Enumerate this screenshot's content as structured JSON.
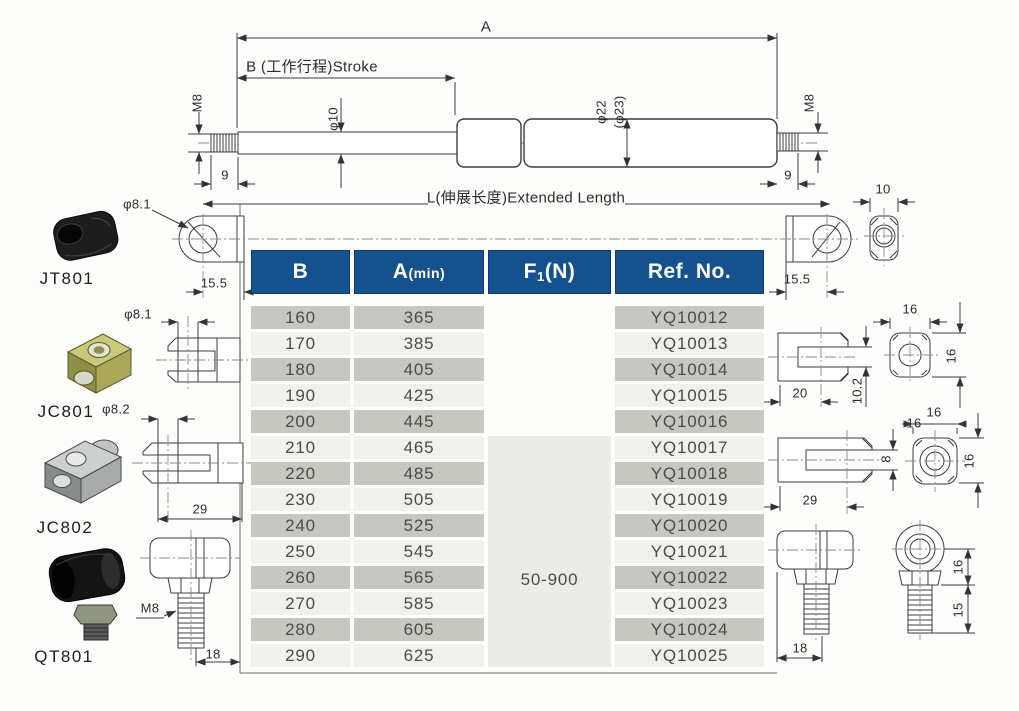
{
  "drawing": {
    "dim_a": "A",
    "dim_b_stroke": "B (工作行程)Stroke",
    "dim_phi10": "φ10",
    "dim_phi22": "φ22",
    "dim_phi23": "(φ23)",
    "dim_m8_left": "M8",
    "dim_m8_right": "M8",
    "dim_9_left": "9",
    "dim_9_right": "9",
    "extended_length": "L(伸展长度)Extended Length",
    "dim_155_left": "15.5",
    "dim_155_right": "15.5"
  },
  "fittings": {
    "jt801": {
      "name": "JT801",
      "hole_dia": "φ8.1"
    },
    "jc801": {
      "name": "JC801",
      "hole_dia": "φ8.1"
    },
    "jc802": {
      "name": "JC802",
      "hole_dia": "φ8.2",
      "width": "29"
    },
    "qt801": {
      "name": "QT801",
      "thread": "M8",
      "width": "18"
    }
  },
  "right_views": {
    "eyelet_side": {
      "width": "10"
    },
    "clevis_small": {
      "width_top": "16",
      "height": "16",
      "depth": "20",
      "slot": "10.2"
    },
    "clevis_big": {
      "width_top_a": "16",
      "width_top_b": "16",
      "height": "16",
      "slot": "8",
      "depth": "29"
    },
    "ball_joint": {
      "eye_height": "16",
      "stud_len": "15",
      "width": "18"
    }
  },
  "table": {
    "headers": {
      "b": "B",
      "a": "A",
      "a_sub": "(min)",
      "f": "F",
      "f_sub": "1",
      "f_tail": "(N)",
      "ref": "Ref. No."
    },
    "f1_value": "50-900",
    "rows": [
      {
        "b": "160",
        "a": "365",
        "ref": "YQ10012"
      },
      {
        "b": "170",
        "a": "385",
        "ref": "YQ10013"
      },
      {
        "b": "180",
        "a": "405",
        "ref": "YQ10014"
      },
      {
        "b": "190",
        "a": "425",
        "ref": "YQ10015"
      },
      {
        "b": "200",
        "a": "445",
        "ref": "YQ10016"
      },
      {
        "b": "210",
        "a": "465",
        "ref": "YQ10017"
      },
      {
        "b": "220",
        "a": "485",
        "ref": "YQ10018"
      },
      {
        "b": "230",
        "a": "505",
        "ref": "YQ10019"
      },
      {
        "b": "240",
        "a": "525",
        "ref": "YQ10020"
      },
      {
        "b": "250",
        "a": "545",
        "ref": "YQ10021"
      },
      {
        "b": "260",
        "a": "565",
        "ref": "YQ10022"
      },
      {
        "b": "270",
        "a": "585",
        "ref": "YQ10023"
      },
      {
        "b": "280",
        "a": "605",
        "ref": "YQ10024"
      },
      {
        "b": "290",
        "a": "625",
        "ref": "YQ10025"
      }
    ]
  }
}
